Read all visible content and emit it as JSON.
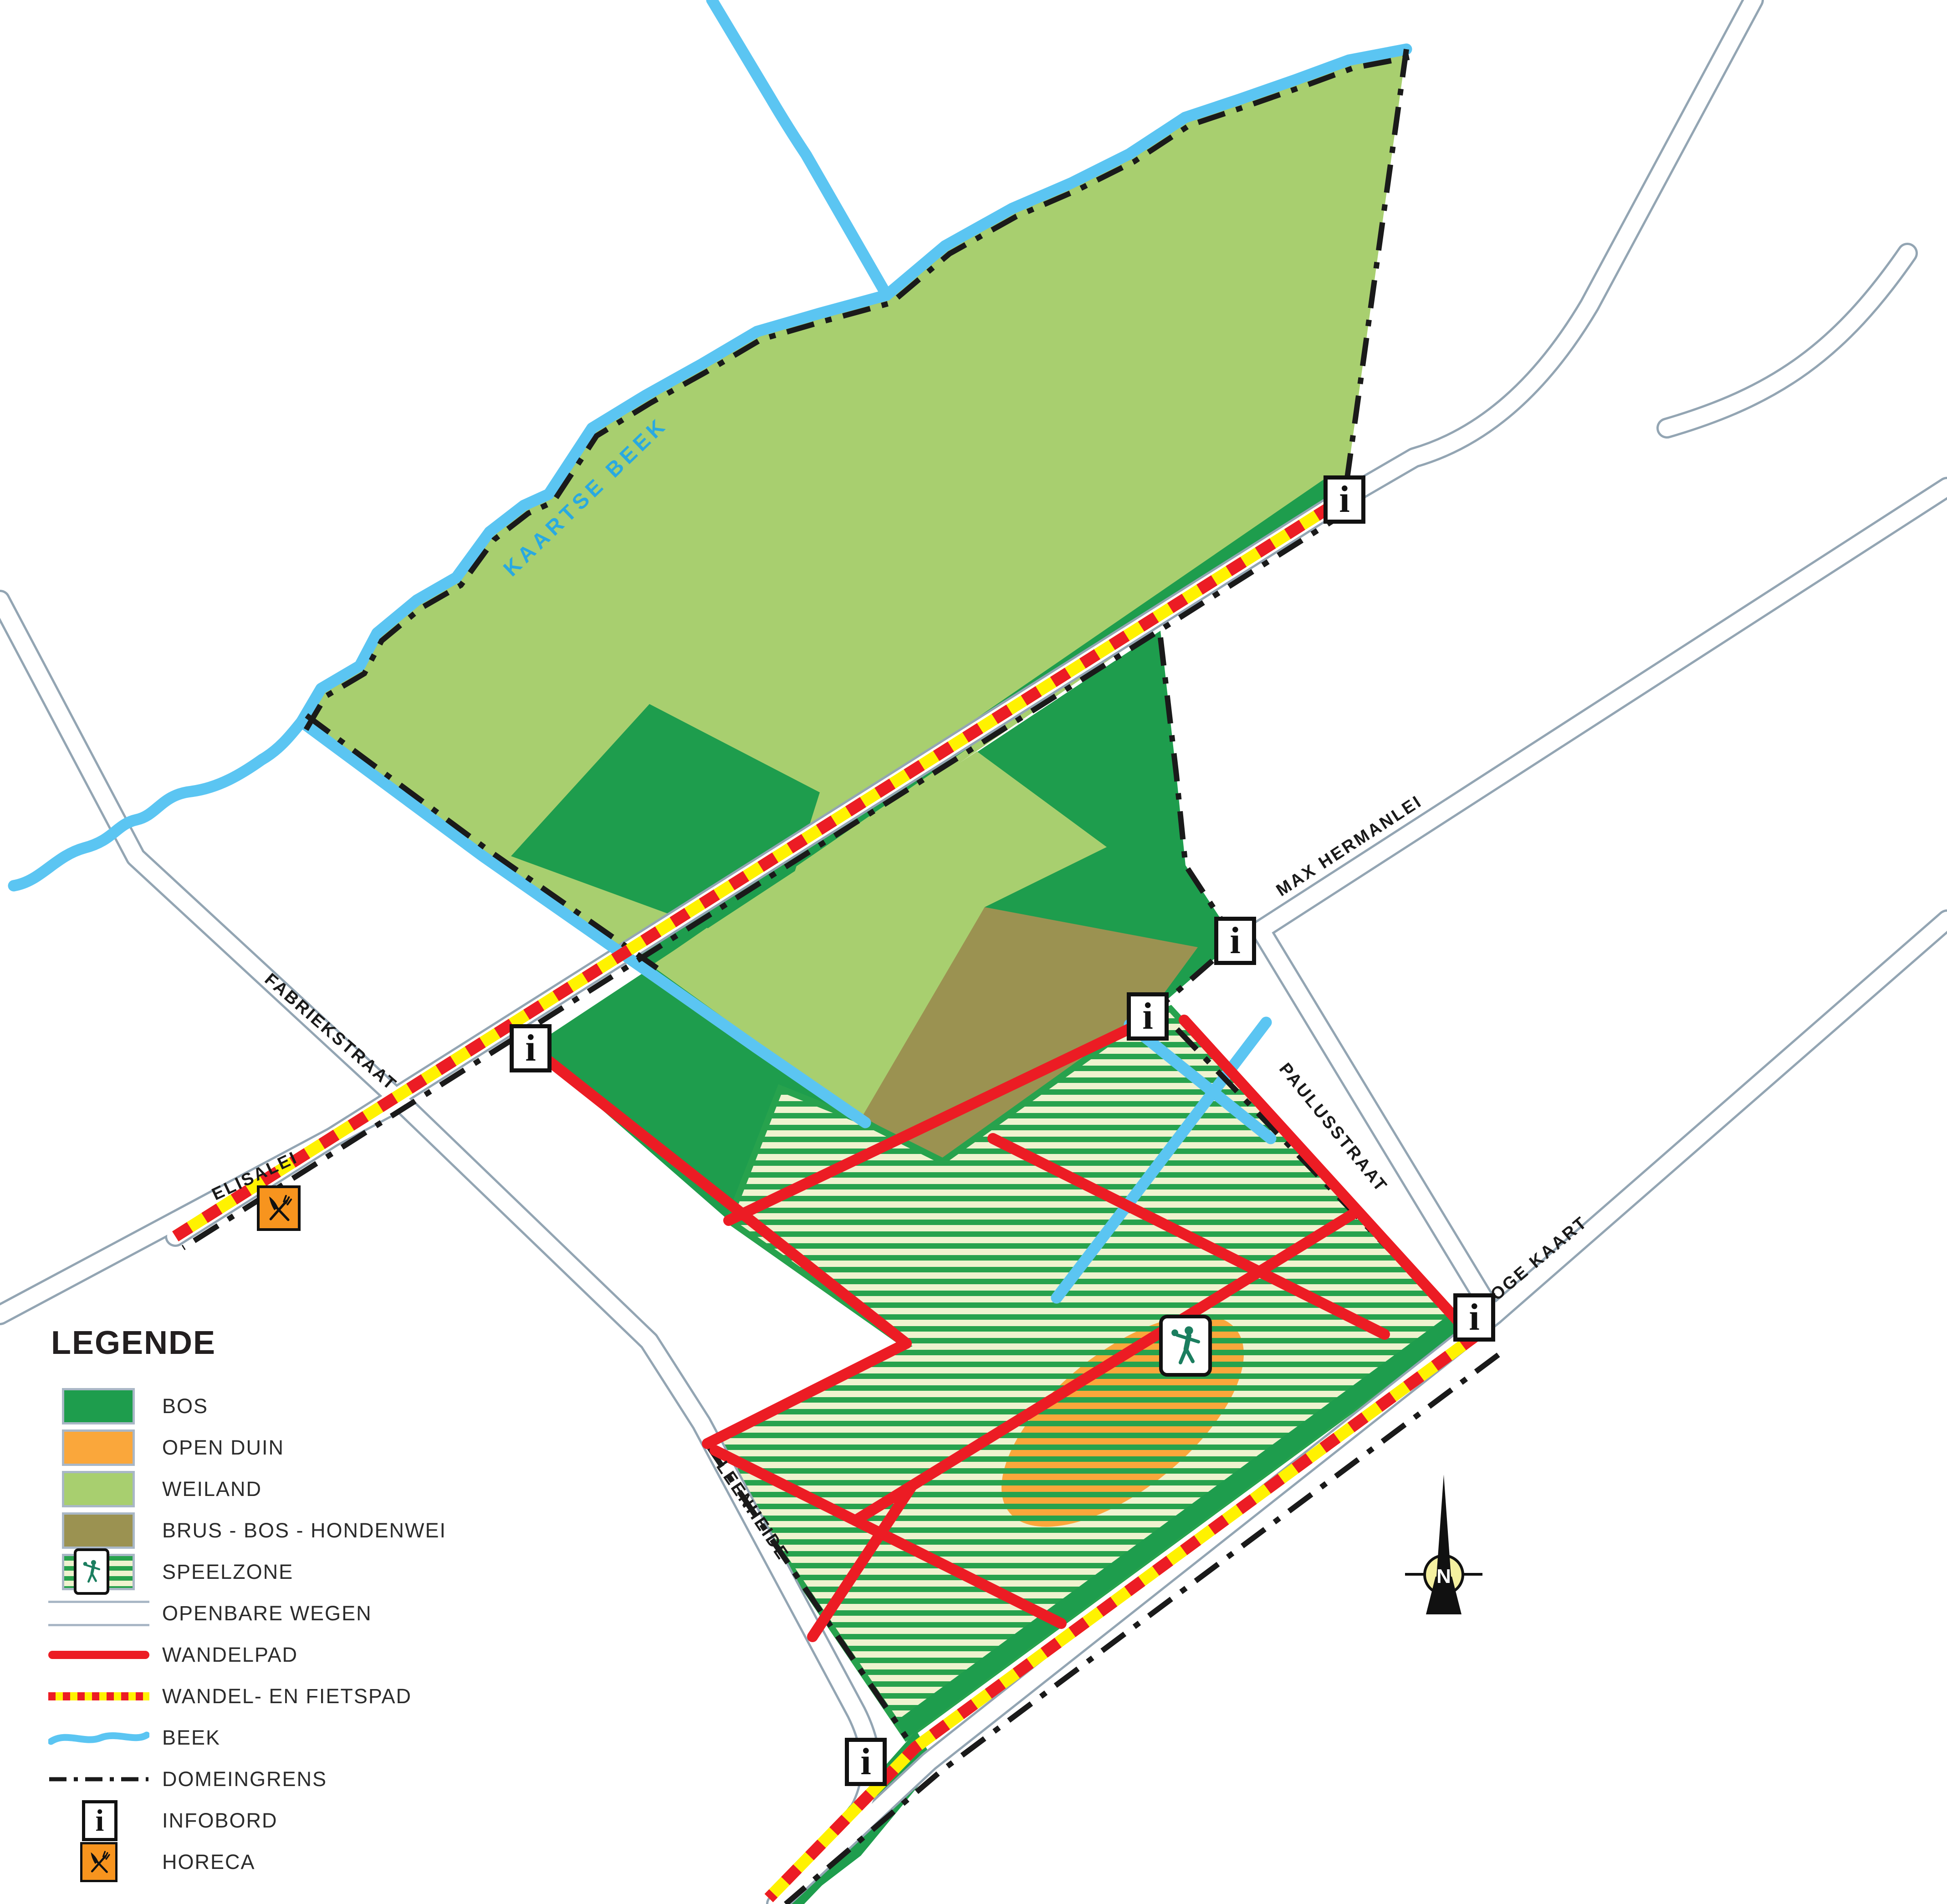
{
  "legend": {
    "title": "LEGENDE",
    "items": [
      {
        "label": "BOS"
      },
      {
        "label": "OPEN DUIN"
      },
      {
        "label": "WEILAND"
      },
      {
        "label": "BRUS - BOS - HONDENWEI"
      },
      {
        "label": "SPEELZONE"
      },
      {
        "label": "OPENBARE WEGEN"
      },
      {
        "label": "WANDELPAD"
      },
      {
        "label": "WANDEL- EN FIETSPAD"
      },
      {
        "label": "BEEK"
      },
      {
        "label": "DOMEINGRENS"
      },
      {
        "label": "INFOBORD"
      },
      {
        "label": "HORECA"
      }
    ]
  },
  "streets": [
    {
      "name": "KAARTSE BEEK"
    },
    {
      "name": "FABRIEKSTRAAT"
    },
    {
      "name": "ELISALEI"
    },
    {
      "name": "MAX HERMANLEI"
    },
    {
      "name": "PAULUSSTRAAT"
    },
    {
      "name": "HOGE KAART"
    },
    {
      "name": "LEENHEIDE"
    }
  ],
  "markers": {
    "infobord_glyph": "i",
    "compass_label": "N",
    "infobord_count": 6
  },
  "colors": {
    "bos": "#1e9d4d",
    "open_duin": "#faa73b",
    "weiland": "#a8cf6f",
    "brus_bos_hondenwei": "#9b9251",
    "speelzone_stripe": "#27a24d",
    "speelzone_bg": "#eff3cf",
    "wandelpad": "#ec1c24",
    "fietspad_geel": "#fff200",
    "beek": "#5bc5f2",
    "domeingrens": "#1a1a1a",
    "horeca": "#f7941e",
    "road_border": "#93a5b3"
  }
}
